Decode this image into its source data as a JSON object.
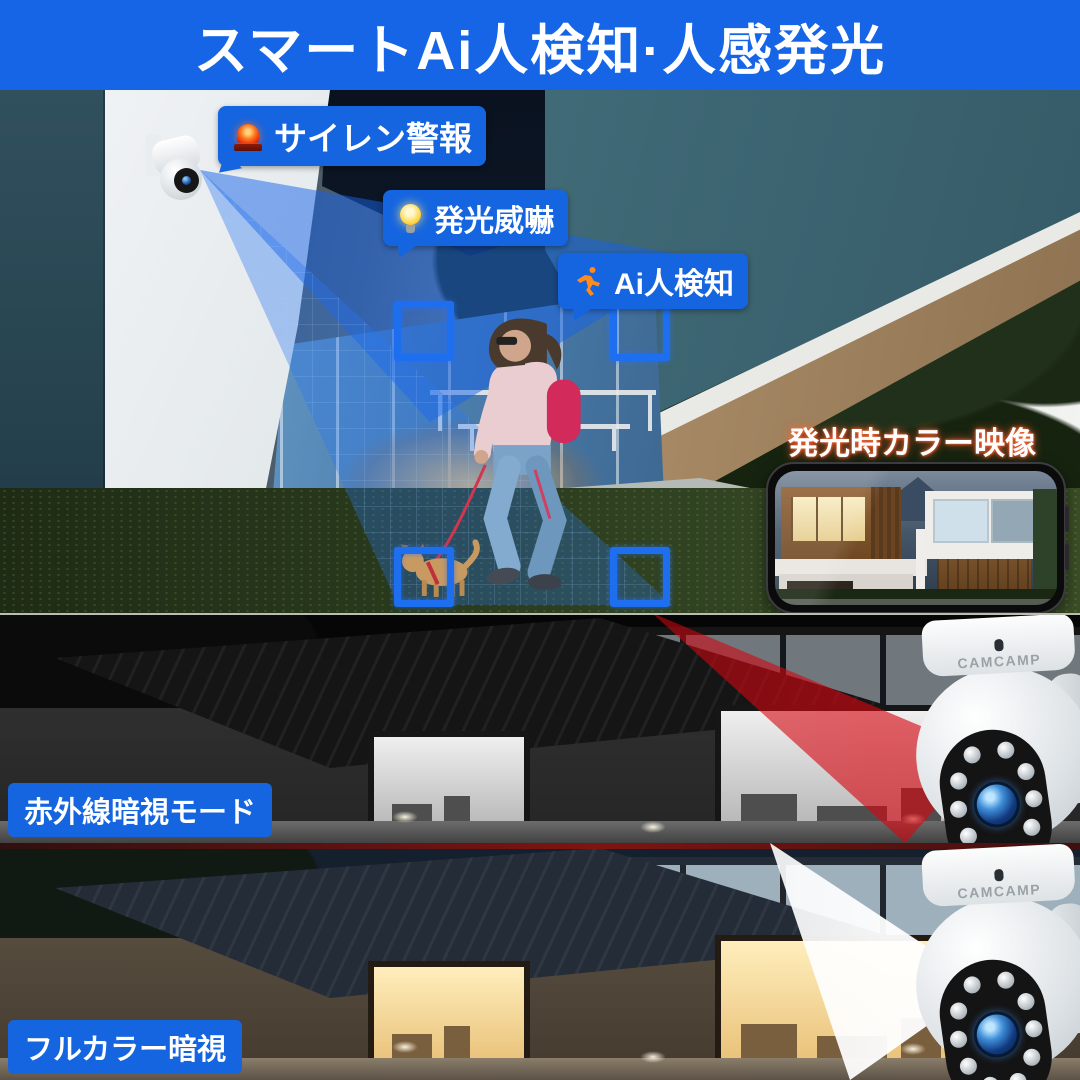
{
  "banner": {
    "title": "スマートAi人検知·人感発光"
  },
  "callouts": {
    "siren": {
      "label": "サイレン警報",
      "icon": "siren-icon"
    },
    "flash": {
      "label": "発光威嚇",
      "icon": "bulb-icon"
    },
    "ai": {
      "label": "Ai人検知",
      "icon": "runner-icon"
    }
  },
  "caption": {
    "color_view": "発光時カラー映像"
  },
  "bands": {
    "ir": {
      "label": "赤外線暗視モード",
      "beam_color": "#d40f16"
    },
    "full_color": {
      "label": "フルカラー暗視",
      "beam_color": "#ffffff"
    }
  },
  "brand": {
    "logo": "CAMCAMP"
  },
  "colors": {
    "banner_bg": "#1565e6",
    "callout_bg": "#1565e0",
    "accent_blue": "#1e6ff0"
  }
}
